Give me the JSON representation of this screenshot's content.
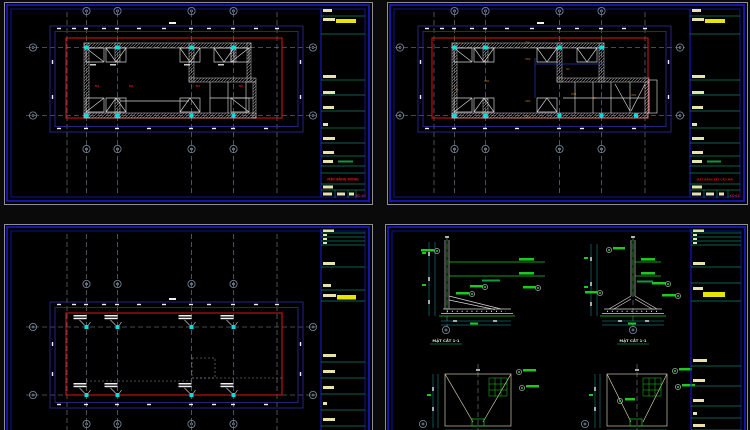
{
  "canvas": {
    "description": "CAD model space with four structural drawing sheets",
    "colors": {
      "background": "#0a0a0a",
      "sheet_border_blue": "#1717bd",
      "plan_outline_red": "#cc1414",
      "linework_white": "#d6d6d6",
      "grid_gray": "#8a95a2",
      "node_cyan": "#00dfe4",
      "rebar_green": "#1ec81e",
      "beam_label_orange": "#d9891a",
      "titleblock_text_cream": "#e6e2a8",
      "highlight_yellow": "#e6e600",
      "divider_teal": "#0b8064",
      "dimension_navy": "#2b2f9e"
    }
  },
  "tl": {
    "sheet_name": "foundation-plan",
    "title": "MẶT BẰNG MÓNG",
    "sheet_no": "KC-01",
    "footing_labels": [
      "M1",
      "M2",
      "M1",
      "M2"
    ]
  },
  "tr": {
    "sheet_name": "roof-framing-plan",
    "title": "MẶT BẰNG KẾT CẤU MÁI",
    "sheet_no": "KC-02",
    "beam_labels": [
      "DD1",
      "DD2",
      "DD1",
      "D1",
      "DD2",
      "D2",
      "DD1",
      "D3",
      "DD2",
      "DD1"
    ]
  },
  "bl": {
    "sheet_name": "column-layout-plan"
  },
  "br": {
    "sheet_name": "foundation-details",
    "section_titles": [
      "MẶT CẮT 1-1",
      "MẶT CẮT 1-1"
    ]
  }
}
